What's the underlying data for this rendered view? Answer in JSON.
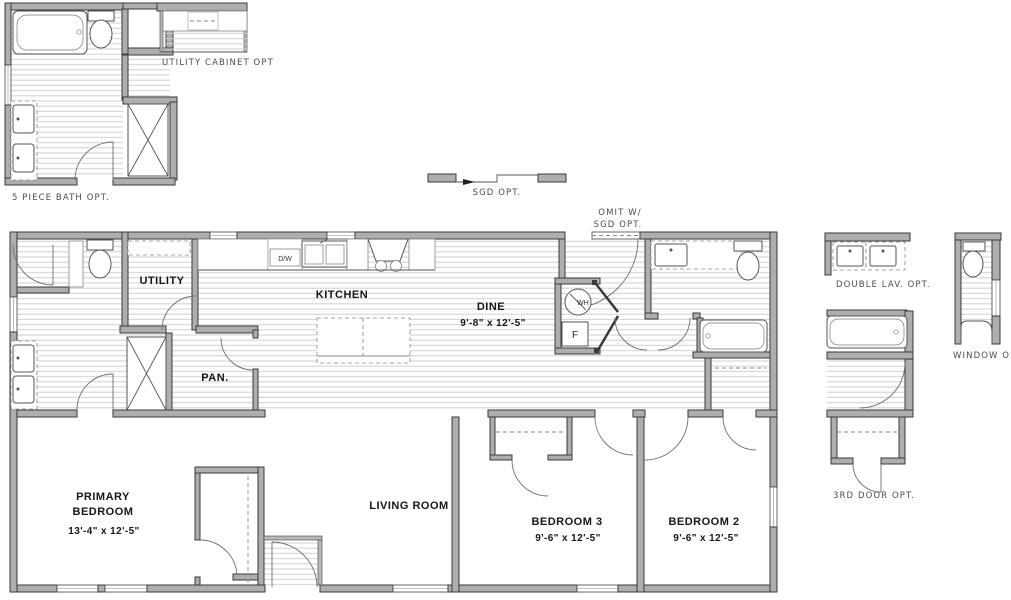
{
  "drawing_title": "Floor Plan",
  "colors": {
    "background": "#ffffff",
    "wall_fill": "#aeaeae",
    "wall_edge": "#3a3a3a",
    "floor_line": "#cfcfcf",
    "fixture_line": "#555555",
    "room_label": "#161616",
    "option_label": "#4d4d4d"
  },
  "rooms": {
    "utility": {
      "name": "UTILITY"
    },
    "pantry": {
      "name": "PAN."
    },
    "kitchen": {
      "name": "KITCHEN"
    },
    "dine": {
      "name": "DINE",
      "dims": "9'-8\" x  12'-5\""
    },
    "primary_bedroom": {
      "name_line1": "PRIMARY",
      "name_line2": "BEDROOM",
      "dims": "13'-4\" x  12'-5\""
    },
    "living_room": {
      "name": "LIVING ROOM"
    },
    "bedroom3": {
      "name": "BEDROOM 3",
      "dims": "9'-6\" x  12'-5\""
    },
    "bedroom2": {
      "name": "BEDROOM 2",
      "dims": "9'-6\" x  12'-5\""
    }
  },
  "appliances": {
    "dishwasher": "D/W",
    "water_heater": "WH",
    "furnace": "F"
  },
  "options": {
    "five_piece_bath": "5 PIECE BATH OPT.",
    "utility_cabinet": "UTILITY CABINET OPT",
    "sgd": "SGD OPT.",
    "omit_with_sgd_line1": "OMIT W/",
    "omit_with_sgd_line2": "SGD OPT.",
    "double_lav": "DOUBLE LAV. OPT.",
    "window": "WINDOW OPT.",
    "third_door": "3RD DOOR OPT."
  }
}
